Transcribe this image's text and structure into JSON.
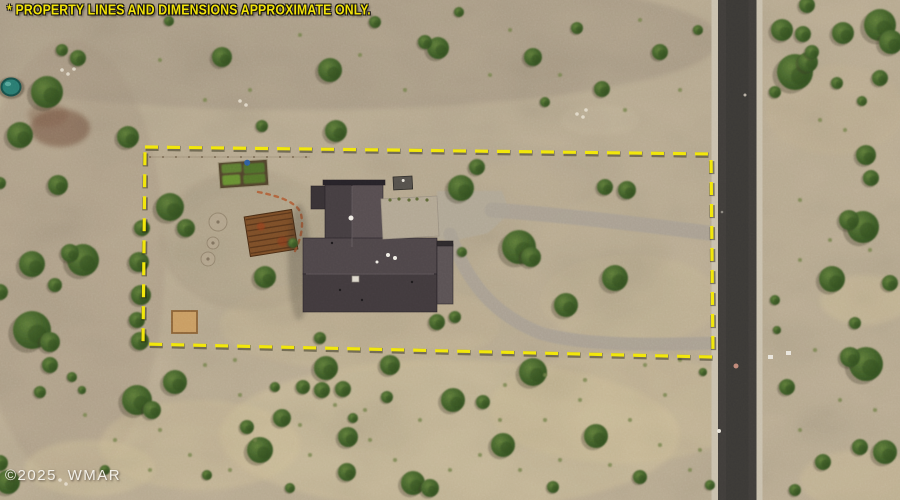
{
  "overlay": {
    "disclaimer": "* PROPERTY LINES AND DIMENSIONS APPROXIMATE ONLY.",
    "watermark": "©2025 WMAR",
    "disclaimer_color": "#f2e30a",
    "watermark_color": "#f2efe7"
  },
  "scene": {
    "width": 900,
    "height": 500,
    "terrain": {
      "base": "#bcae94",
      "fine_noise_opacity": 0.14,
      "coarse_noise_opacity": 0.2
    },
    "bush_colors": {
      "light": "#5f7c3a",
      "mid": "#42602a",
      "dark": "#2d4a1e"
    },
    "tuft_color": "#72814a",
    "patches": [
      [
        300,
        40,
        420,
        70,
        "#9b8d7b",
        0.38
      ],
      [
        70,
        260,
        95,
        220,
        "#a4937f",
        0.32
      ],
      [
        450,
        435,
        230,
        75,
        "#d6c69e",
        0.42
      ],
      [
        620,
        408,
        130,
        55,
        "#d3c29a",
        0.36
      ],
      [
        200,
        445,
        100,
        45,
        "#d3c29a",
        0.38
      ],
      [
        90,
        468,
        65,
        28,
        "#d6c69e",
        0.42
      ],
      [
        360,
        325,
        140,
        45,
        "#cdbd97",
        0.32
      ],
      [
        630,
        300,
        90,
        45,
        "#cdbd97",
        0.28
      ],
      [
        250,
        240,
        90,
        70,
        "#a79a82",
        0.38
      ],
      [
        480,
        180,
        120,
        40,
        "#b3a78f",
        0.32
      ],
      [
        865,
        300,
        45,
        25,
        "#d2c29b",
        0.42
      ],
      [
        835,
        110,
        70,
        45,
        "#c4b493",
        0.32
      ],
      [
        860,
        480,
        60,
        30,
        "#d0c099",
        0.38
      ],
      [
        60,
        128,
        30,
        19,
        "#6d4a38",
        0.5
      ],
      [
        48,
        115,
        20,
        12,
        "#7d5a44",
        0.32
      ],
      [
        600,
        120,
        40,
        15,
        "#c9bca0",
        0.35
      ],
      [
        420,
        250,
        250,
        90,
        "#b9ab90",
        0.3
      ]
    ],
    "rocks": [
      [
        62,
        70
      ],
      [
        68,
        74
      ],
      [
        74,
        69
      ],
      [
        240,
        101
      ],
      [
        246,
        105
      ],
      [
        577,
        114
      ],
      [
        583,
        117
      ],
      [
        60,
        480
      ],
      [
        66,
        484
      ],
      [
        586,
        110
      ]
    ],
    "bushes": [
      [
        47,
        92,
        16
      ],
      [
        78,
        58,
        8
      ],
      [
        20,
        135,
        13
      ],
      [
        62,
        50,
        6
      ],
      [
        58,
        185,
        10
      ],
      [
        0,
        183,
        6
      ],
      [
        32,
        264,
        13
      ],
      [
        83,
        260,
        16
      ],
      [
        70,
        253,
        9
      ],
      [
        55,
        285,
        7
      ],
      [
        0,
        292,
        8
      ],
      [
        32,
        330,
        19
      ],
      [
        50,
        342,
        10
      ],
      [
        50,
        365,
        8
      ],
      [
        72,
        377,
        5
      ],
      [
        40,
        392,
        6
      ],
      [
        82,
        390,
        4
      ],
      [
        8,
        482,
        12
      ],
      [
        0,
        463,
        8
      ],
      [
        105,
        470,
        5
      ],
      [
        142,
        228,
        8
      ],
      [
        139,
        262,
        10
      ],
      [
        141,
        295,
        10
      ],
      [
        137,
        320,
        8
      ],
      [
        140,
        341,
        9
      ],
      [
        169,
        21,
        5
      ],
      [
        222,
        57,
        10
      ],
      [
        330,
        70,
        12
      ],
      [
        375,
        22,
        6
      ],
      [
        438,
        48,
        11
      ],
      [
        425,
        42,
        7
      ],
      [
        533,
        57,
        9
      ],
      [
        577,
        28,
        6
      ],
      [
        602,
        89,
        8
      ],
      [
        660,
        52,
        8
      ],
      [
        128,
        137,
        11
      ],
      [
        262,
        126,
        6
      ],
      [
        336,
        131,
        11
      ],
      [
        459,
        12,
        5
      ],
      [
        545,
        102,
        5
      ],
      [
        698,
        30,
        5
      ],
      [
        170,
        207,
        14
      ],
      [
        186,
        228,
        9
      ],
      [
        265,
        277,
        11
      ],
      [
        293,
        243,
        5
      ],
      [
        461,
        188,
        13
      ],
      [
        477,
        167,
        8
      ],
      [
        519,
        247,
        17
      ],
      [
        531,
        257,
        10
      ],
      [
        566,
        305,
        12
      ],
      [
        615,
        278,
        13
      ],
      [
        605,
        187,
        8
      ],
      [
        627,
        190,
        9
      ],
      [
        437,
        322,
        8
      ],
      [
        455,
        317,
        6
      ],
      [
        320,
        338,
        6
      ],
      [
        462,
        252,
        5
      ],
      [
        326,
        368,
        12
      ],
      [
        390,
        365,
        10
      ],
      [
        275,
        387,
        5
      ],
      [
        303,
        387,
        7
      ],
      [
        322,
        390,
        8
      ],
      [
        343,
        389,
        8
      ],
      [
        387,
        397,
        6
      ],
      [
        282,
        418,
        9
      ],
      [
        353,
        418,
        5
      ],
      [
        348,
        437,
        10
      ],
      [
        453,
        400,
        12
      ],
      [
        483,
        402,
        7
      ],
      [
        260,
        450,
        13
      ],
      [
        503,
        445,
        12
      ],
      [
        347,
        472,
        9
      ],
      [
        413,
        483,
        12
      ],
      [
        430,
        488,
        9
      ],
      [
        290,
        488,
        5
      ],
      [
        175,
        382,
        12
      ],
      [
        137,
        400,
        15
      ],
      [
        152,
        410,
        9
      ],
      [
        247,
        427,
        7
      ],
      [
        596,
        436,
        12
      ],
      [
        533,
        372,
        14
      ],
      [
        640,
        477,
        7
      ],
      [
        703,
        372,
        4
      ],
      [
        710,
        485,
        5
      ],
      [
        207,
        475,
        5
      ],
      [
        553,
        487,
        6
      ],
      [
        807,
        5,
        8
      ],
      [
        782,
        30,
        11
      ],
      [
        803,
        34,
        8
      ],
      [
        843,
        33,
        11
      ],
      [
        880,
        25,
        16
      ],
      [
        891,
        42,
        12
      ],
      [
        795,
        72,
        18
      ],
      [
        808,
        62,
        10
      ],
      [
        812,
        52,
        7
      ],
      [
        880,
        78,
        8
      ],
      [
        837,
        83,
        6
      ],
      [
        862,
        101,
        5
      ],
      [
        775,
        92,
        6
      ],
      [
        866,
        155,
        10
      ],
      [
        871,
        178,
        8
      ],
      [
        863,
        227,
        16
      ],
      [
        849,
        220,
        10
      ],
      [
        832,
        279,
        13
      ],
      [
        890,
        283,
        8
      ],
      [
        775,
        300,
        5
      ],
      [
        855,
        323,
        6
      ],
      [
        866,
        364,
        17
      ],
      [
        850,
        357,
        10
      ],
      [
        787,
        387,
        8
      ],
      [
        885,
        452,
        12
      ],
      [
        860,
        447,
        8
      ],
      [
        823,
        462,
        8
      ],
      [
        795,
        490,
        6
      ],
      [
        777,
        330,
        4
      ]
    ],
    "tufts": [
      [
        150,
        470
      ],
      [
        190,
        455
      ],
      [
        230,
        470
      ],
      [
        310,
        455
      ],
      [
        370,
        440
      ],
      [
        395,
        460
      ],
      [
        450,
        470
      ],
      [
        480,
        455
      ],
      [
        520,
        470
      ],
      [
        560,
        460
      ],
      [
        610,
        465
      ],
      [
        660,
        445
      ],
      [
        690,
        470
      ],
      [
        240,
        395
      ],
      [
        255,
        440
      ],
      [
        365,
        410
      ],
      [
        420,
        420
      ],
      [
        500,
        420
      ],
      [
        545,
        420
      ],
      [
        580,
        400
      ],
      [
        630,
        420
      ],
      [
        665,
        395
      ],
      [
        680,
        360
      ],
      [
        205,
        365
      ],
      [
        235,
        360
      ],
      [
        160,
        430
      ],
      [
        115,
        440
      ],
      [
        85,
        415
      ],
      [
        300,
        425
      ],
      [
        335,
        405
      ],
      [
        585,
        380
      ],
      [
        645,
        365
      ],
      [
        700,
        450
      ],
      [
        545,
        375
      ],
      [
        505,
        385
      ],
      [
        205,
        100
      ],
      [
        250,
        90
      ],
      [
        405,
        90
      ],
      [
        490,
        75
      ],
      [
        560,
        75
      ],
      [
        625,
        110
      ],
      [
        680,
        90
      ],
      [
        160,
        60
      ],
      [
        300,
        35
      ],
      [
        360,
        55
      ],
      [
        510,
        30
      ],
      [
        640,
        20
      ],
      [
        820,
        120
      ],
      [
        845,
        130
      ],
      [
        800,
        200
      ],
      [
        830,
        240
      ],
      [
        870,
        250
      ],
      [
        800,
        260
      ],
      [
        815,
        350
      ],
      [
        840,
        400
      ],
      [
        800,
        430
      ],
      [
        875,
        410
      ]
    ],
    "driveway": {
      "color": "#a9a092",
      "apron_color": "#b0a795",
      "apron": "437,191 502,191 510,213 488,233 452,241 437,239",
      "paths": [
        {
          "d": "M 492 210 C 560 215 640 224 716 234",
          "w": 15
        },
        {
          "d": "M 450 234 C 466 280 492 314 540 333 C 584 346 652 345 716 343",
          "w": 13
        }
      ]
    },
    "road": {
      "x": 711.5,
      "shoulder_w": 6,
      "asphalt_x": 718,
      "asphalt_w": 38.5,
      "color": "#403d3a",
      "shoulder_color": "#c9c0ad",
      "marks": [
        [
          719,
          431,
          2,
          "#e8e4da"
        ],
        [
          736,
          366,
          2.5,
          "#c08878"
        ],
        [
          745,
          95,
          1.5,
          "#b7b0a4"
        ],
        [
          722,
          212,
          1.3,
          "#8a867e"
        ]
      ]
    },
    "boundary": {
      "points": "145,147 711,154 713,357 143,344",
      "color": "#f2e70c",
      "width": 3.2,
      "dash": "13 9",
      "shadow": "rgba(30,30,10,0.45)"
    },
    "house": {
      "shadow": [
        299,
        262,
        11,
        58
      ],
      "nw_roof": [
        311,
        186,
        17,
        23,
        "#383235"
      ],
      "north_left": [
        325,
        183,
        27,
        67,
        "#453e41"
      ],
      "north_right": [
        352,
        183,
        31,
        67,
        "#564d50"
      ],
      "eave": [
        323,
        180,
        62,
        5,
        "#272329"
      ],
      "main_top": [
        303,
        238,
        134,
        36,
        "#4e4649"
      ],
      "main_bottom": [
        303,
        274,
        134,
        38,
        "#413a3d"
      ],
      "east_ext": [
        437,
        244,
        16,
        60,
        "#5a5254"
      ],
      "east_eave": [
        437,
        241,
        16,
        5,
        "#2e2a2c"
      ],
      "ridges": [
        [
          352,
          186,
          352,
          247
        ],
        [
          306,
          274,
          434,
          274
        ]
      ],
      "ridge_color": "#6b6265",
      "outline": "#241f23",
      "pad": {
        "points": "381,199 437,196 439,236 383,239",
        "fill": "#b2a793",
        "stroke": "#9a9081"
      },
      "pad_plants": [
        [
          390,
          200
        ],
        [
          399,
          199
        ],
        [
          409,
          200
        ],
        [
          417,
          199
        ],
        [
          427,
          200
        ]
      ],
      "skylights": [
        [
          351,
          218,
          2.5
        ],
        [
          388,
          255,
          2
        ],
        [
          395,
          258,
          2
        ],
        [
          377,
          262,
          1.5
        ]
      ],
      "skylight_rect": [
        352,
        276,
        7,
        6
      ],
      "vents": [
        [
          332,
          243
        ],
        [
          362,
          300
        ],
        [
          412,
          282
        ],
        [
          340,
          290
        ]
      ],
      "shed": {
        "rect": [
          393,
          177,
          19,
          13
        ],
        "fill": "#55514c",
        "rotate": -3,
        "dot": [
          403,
          181
        ]
      }
    },
    "features": {
      "pond": {
        "cx": 11,
        "cy": 87,
        "rx": 9.5,
        "ry": 8.5,
        "fill": "#2a7b71",
        "edge": "#17504a",
        "halo": [
          11,
          88,
          13.5,
          11,
          "#5a5140"
        ],
        "glint": [
          8,
          84,
          3.2,
          2.2,
          "#63b0a4"
        ]
      },
      "garden": {
        "rotate": -4,
        "bed": [
          219,
          161,
          49,
          26
        ],
        "bed_fill": "#52432d",
        "bed_stroke": "#9a8f74",
        "rows": [
          [
            222,
            163,
            20,
            9,
            "#5d7d31"
          ],
          [
            244,
            164,
            21,
            10,
            "#4f7029"
          ],
          [
            222,
            174,
            18,
            10,
            "#679033"
          ],
          [
            243,
            175,
            22,
            9,
            "#55752c"
          ]
        ],
        "barrel": [
          248,
          163,
          3,
          "#2f5f9e"
        ]
      },
      "corral": {
        "rotate": -9,
        "rect": [
          247,
          213,
          48,
          40
        ],
        "fill": "#7c4e28",
        "stroke": "#4a2d15",
        "slat_color": "#55341a",
        "slats": 7,
        "rust": [
          [
            262,
            225,
            4,
            "#a33f1f"
          ],
          [
            281,
            243,
            5,
            "#8f3a1c"
          ]
        ]
      },
      "sandpen": {
        "rect": [
          172,
          311,
          25,
          22
        ],
        "fill": "#c99d63",
        "stroke": "#8a6236"
      },
      "dirt_circles": [
        [
          218,
          222,
          9
        ],
        [
          213,
          243,
          6
        ],
        [
          208,
          259,
          7
        ]
      ],
      "dirt_fill": "#b3a58d",
      "dirt_stroke": "#91826c",
      "stone_path": {
        "d": "M 258 192 C 284 197 298 204 301 214 C 304 228 300 240 295 251",
        "color": "#b05a31"
      },
      "fence": {
        "x1": 150,
        "y1": 157,
        "x2": 310,
        "y2": 157,
        "color": "#6b5b45",
        "post_step": 13
      },
      "markers": [
        [
          768,
          355,
          5,
          4
        ],
        [
          786,
          351,
          5,
          4
        ]
      ]
    }
  }
}
